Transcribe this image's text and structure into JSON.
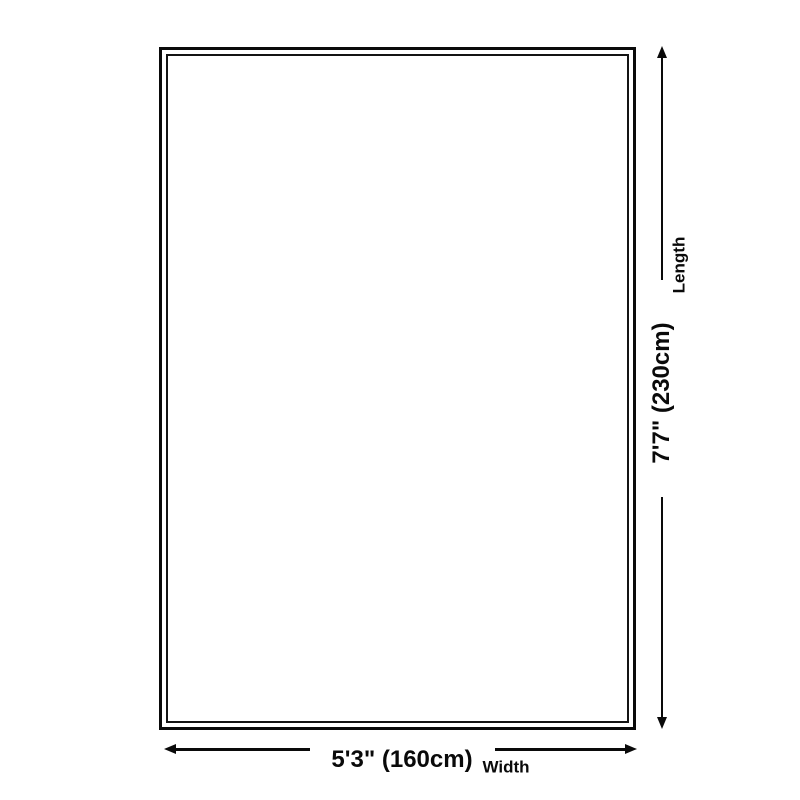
{
  "diagram": {
    "type": "product-dimension-diagram",
    "background_color": "#ffffff",
    "line_color": "#0a0a0a",
    "rug": {
      "shape": "rectangle",
      "border_style": "double"
    },
    "length_dimension": {
      "value": "7'7\" (230cm)",
      "label": "Length",
      "orientation": "vertical",
      "side": "right"
    },
    "width_dimension": {
      "value": "5'3\" (160cm)",
      "label": "Width",
      "orientation": "horizontal",
      "side": "bottom"
    }
  }
}
